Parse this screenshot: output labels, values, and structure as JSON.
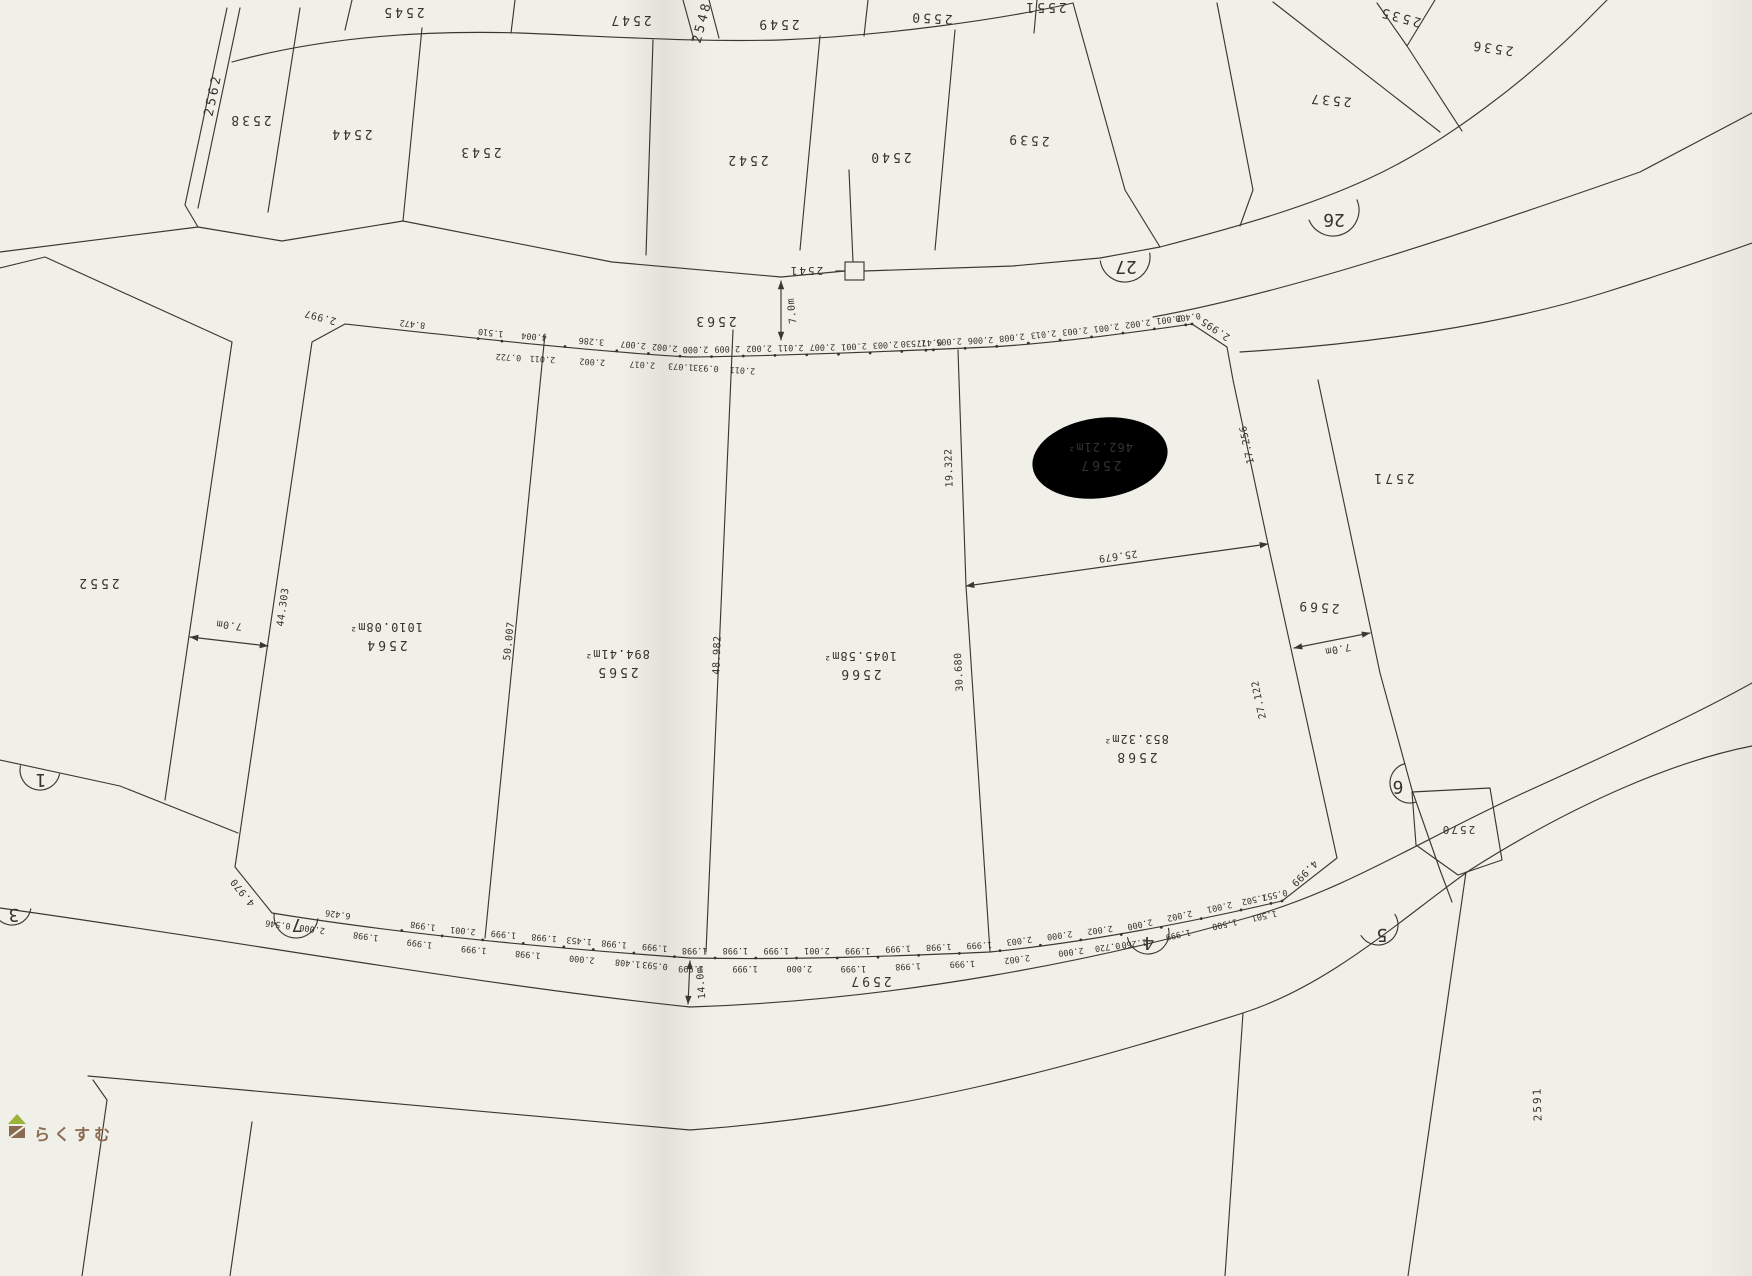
{
  "labels": {
    "2535": "2535",
    "2536": "2536",
    "2537": "2537",
    "2538": "2538",
    "2539": "2539",
    "2540": "2540",
    "2541": "2541",
    "2542": "2542",
    "2543": "2543",
    "2544": "2544",
    "2545": "2545",
    "2547": "2547",
    "2548": "2548",
    "2549": "2549",
    "2550": "2550",
    "2551": "2551",
    "2552": "2552",
    "2562": "2562",
    "2563": "2563",
    "2564": "2564",
    "2565": "2565",
    "2566": "2566",
    "2567": "2567",
    "2568": "2568",
    "2569": "2569",
    "2570": "2570",
    "2571": "2571",
    "2591": "2591",
    "2597": "2597"
  },
  "areas": {
    "2564": "1010.08m²",
    "2565": "894.41m²",
    "2566": "1045.58m²",
    "2567": "462.21m²",
    "2568": "853.32m²"
  },
  "roads": {
    "26": "26",
    "27": "27",
    "7": "7",
    "1": "1",
    "3": "3",
    "4": "4",
    "5": "5",
    "6": "6"
  },
  "dims": {
    "top_row1": [
      "8.472",
      "1.510",
      "4.004",
      "3.286",
      "2.007",
      "2.002",
      "2.000",
      "2.009",
      "2.002",
      "2.011",
      "2.007",
      "2.001",
      "2.003",
      "1.530",
      "0.477",
      "2.005",
      "2.006",
      "2.008",
      "2.013",
      "2.003",
      "2.001",
      "2.002",
      "2.001",
      "0.400"
    ],
    "top_row2": [
      "0.722",
      "2.011",
      "2.002",
      "2.017",
      "1.073",
      "0.933",
      "2.011"
    ],
    "bottom_row1": [
      "6.426",
      "1.998",
      "2.001",
      "1.999",
      "1.998",
      "1.453",
      "1.998",
      "1.999",
      "1.998",
      "1.998",
      "1.999",
      "2.001",
      "1.999",
      "1.999",
      "1.998",
      "1.999",
      "2.003",
      "2.000",
      "2.002",
      "2.000",
      "2.002",
      "2.001",
      "1.502",
      "0.557"
    ],
    "bottom_row2": [
      "0.546",
      "2.000",
      "1.998",
      "1.999",
      "1.999",
      "1.998",
      "2.000",
      "1.408",
      "0.593",
      "1.999",
      "1.999",
      "2.000",
      "1.999",
      "1.998",
      "1.999",
      "2.002",
      "2.000",
      "0.720",
      "1.260",
      "1.999",
      "1.500",
      "1.501"
    ],
    "singles": {
      "left_edge": "44.303",
      "d2564_2565": "50.007",
      "d2565_2566": "48.982",
      "d2567_left": "19.322",
      "d2568_left": "30.680",
      "d2568_top": "25.679",
      "d2567_right": "17.256",
      "d2568_right": "27.122",
      "road_top_width": "7.0m",
      "road_left_width": "7.0m",
      "road_2569_width": "7.0m",
      "road_bottom_width": "14.0m",
      "corner_left": "4.970",
      "corner_right": "4.999",
      "corner_top_left": "2.997",
      "corner_top_right": "2.995"
    }
  },
  "watermark": {
    "text": "らくすむ"
  },
  "colors": {
    "paper": "#f1f0e8",
    "ink": "#3b3833",
    "pencil": "#6f6d65",
    "logo_brown": "#8a6a50",
    "logo_green": "#9ab23a"
  }
}
